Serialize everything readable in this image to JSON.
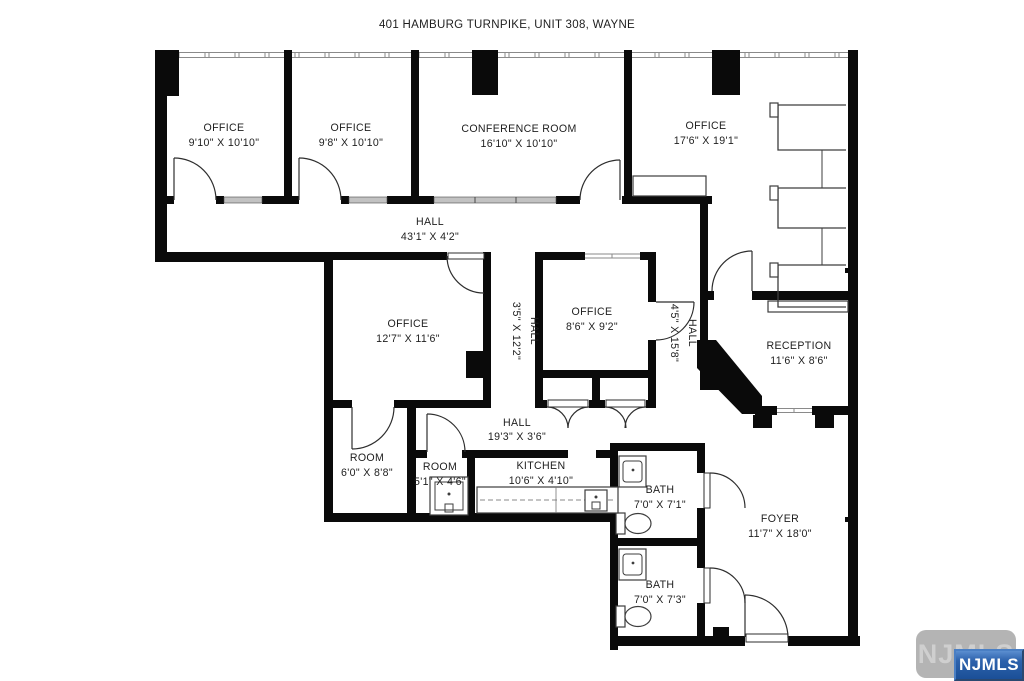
{
  "title": "401 HAMBURG TURNPIKE, UNIT 308, WAYNE",
  "rooms": {
    "office1": {
      "name": "OFFICE",
      "dims": "9'10\" X 10'10\""
    },
    "office2": {
      "name": "OFFICE",
      "dims": "9'8\" X 10'10\""
    },
    "conference": {
      "name": "CONFERENCE ROOM",
      "dims": "16'10\" X 10'10\""
    },
    "office4": {
      "name": "OFFICE",
      "dims": "17'6\" X 19'1\""
    },
    "hall_main": {
      "name": "HALL",
      "dims": "43'1\" X 4'2\""
    },
    "office5": {
      "name": "OFFICE",
      "dims": "12'7\" X 11'6\""
    },
    "hall_v1": {
      "name": "HALL",
      "dims": "3'5\" X 12'2\""
    },
    "office6": {
      "name": "OFFICE",
      "dims": "8'6\" X 9'2\""
    },
    "hall_v2": {
      "name": "HALL",
      "dims": "4'5\" X 15'8\""
    },
    "reception": {
      "name": "RECEPTION",
      "dims": "11'6\" X 8'6\""
    },
    "room1": {
      "name": "ROOM",
      "dims": "6'0\" X 8'8\""
    },
    "room2": {
      "name": "ROOM",
      "dims": "5'1\" X 4'6\""
    },
    "kitchen": {
      "name": "KITCHEN",
      "dims": "10'6\" X 4'10\""
    },
    "hall_lower": {
      "name": "HALL",
      "dims": "19'3\" X 3'6\""
    },
    "bath1": {
      "name": "BATH",
      "dims": "7'0\" X 7'1\""
    },
    "bath2": {
      "name": "BATH",
      "dims": "7'0\" X 7'3\""
    },
    "foyer": {
      "name": "FOYER",
      "dims": "11'7\" X 18'0\""
    }
  },
  "watermark": {
    "ghost": "NJMLS",
    "badge": "NJMLS"
  },
  "colors": {
    "wall": "#0a0a0a",
    "glass_partition": "#c2c2c2",
    "watermark_gray": "#b4b4b4",
    "badge_blue": "#1b4f97"
  }
}
